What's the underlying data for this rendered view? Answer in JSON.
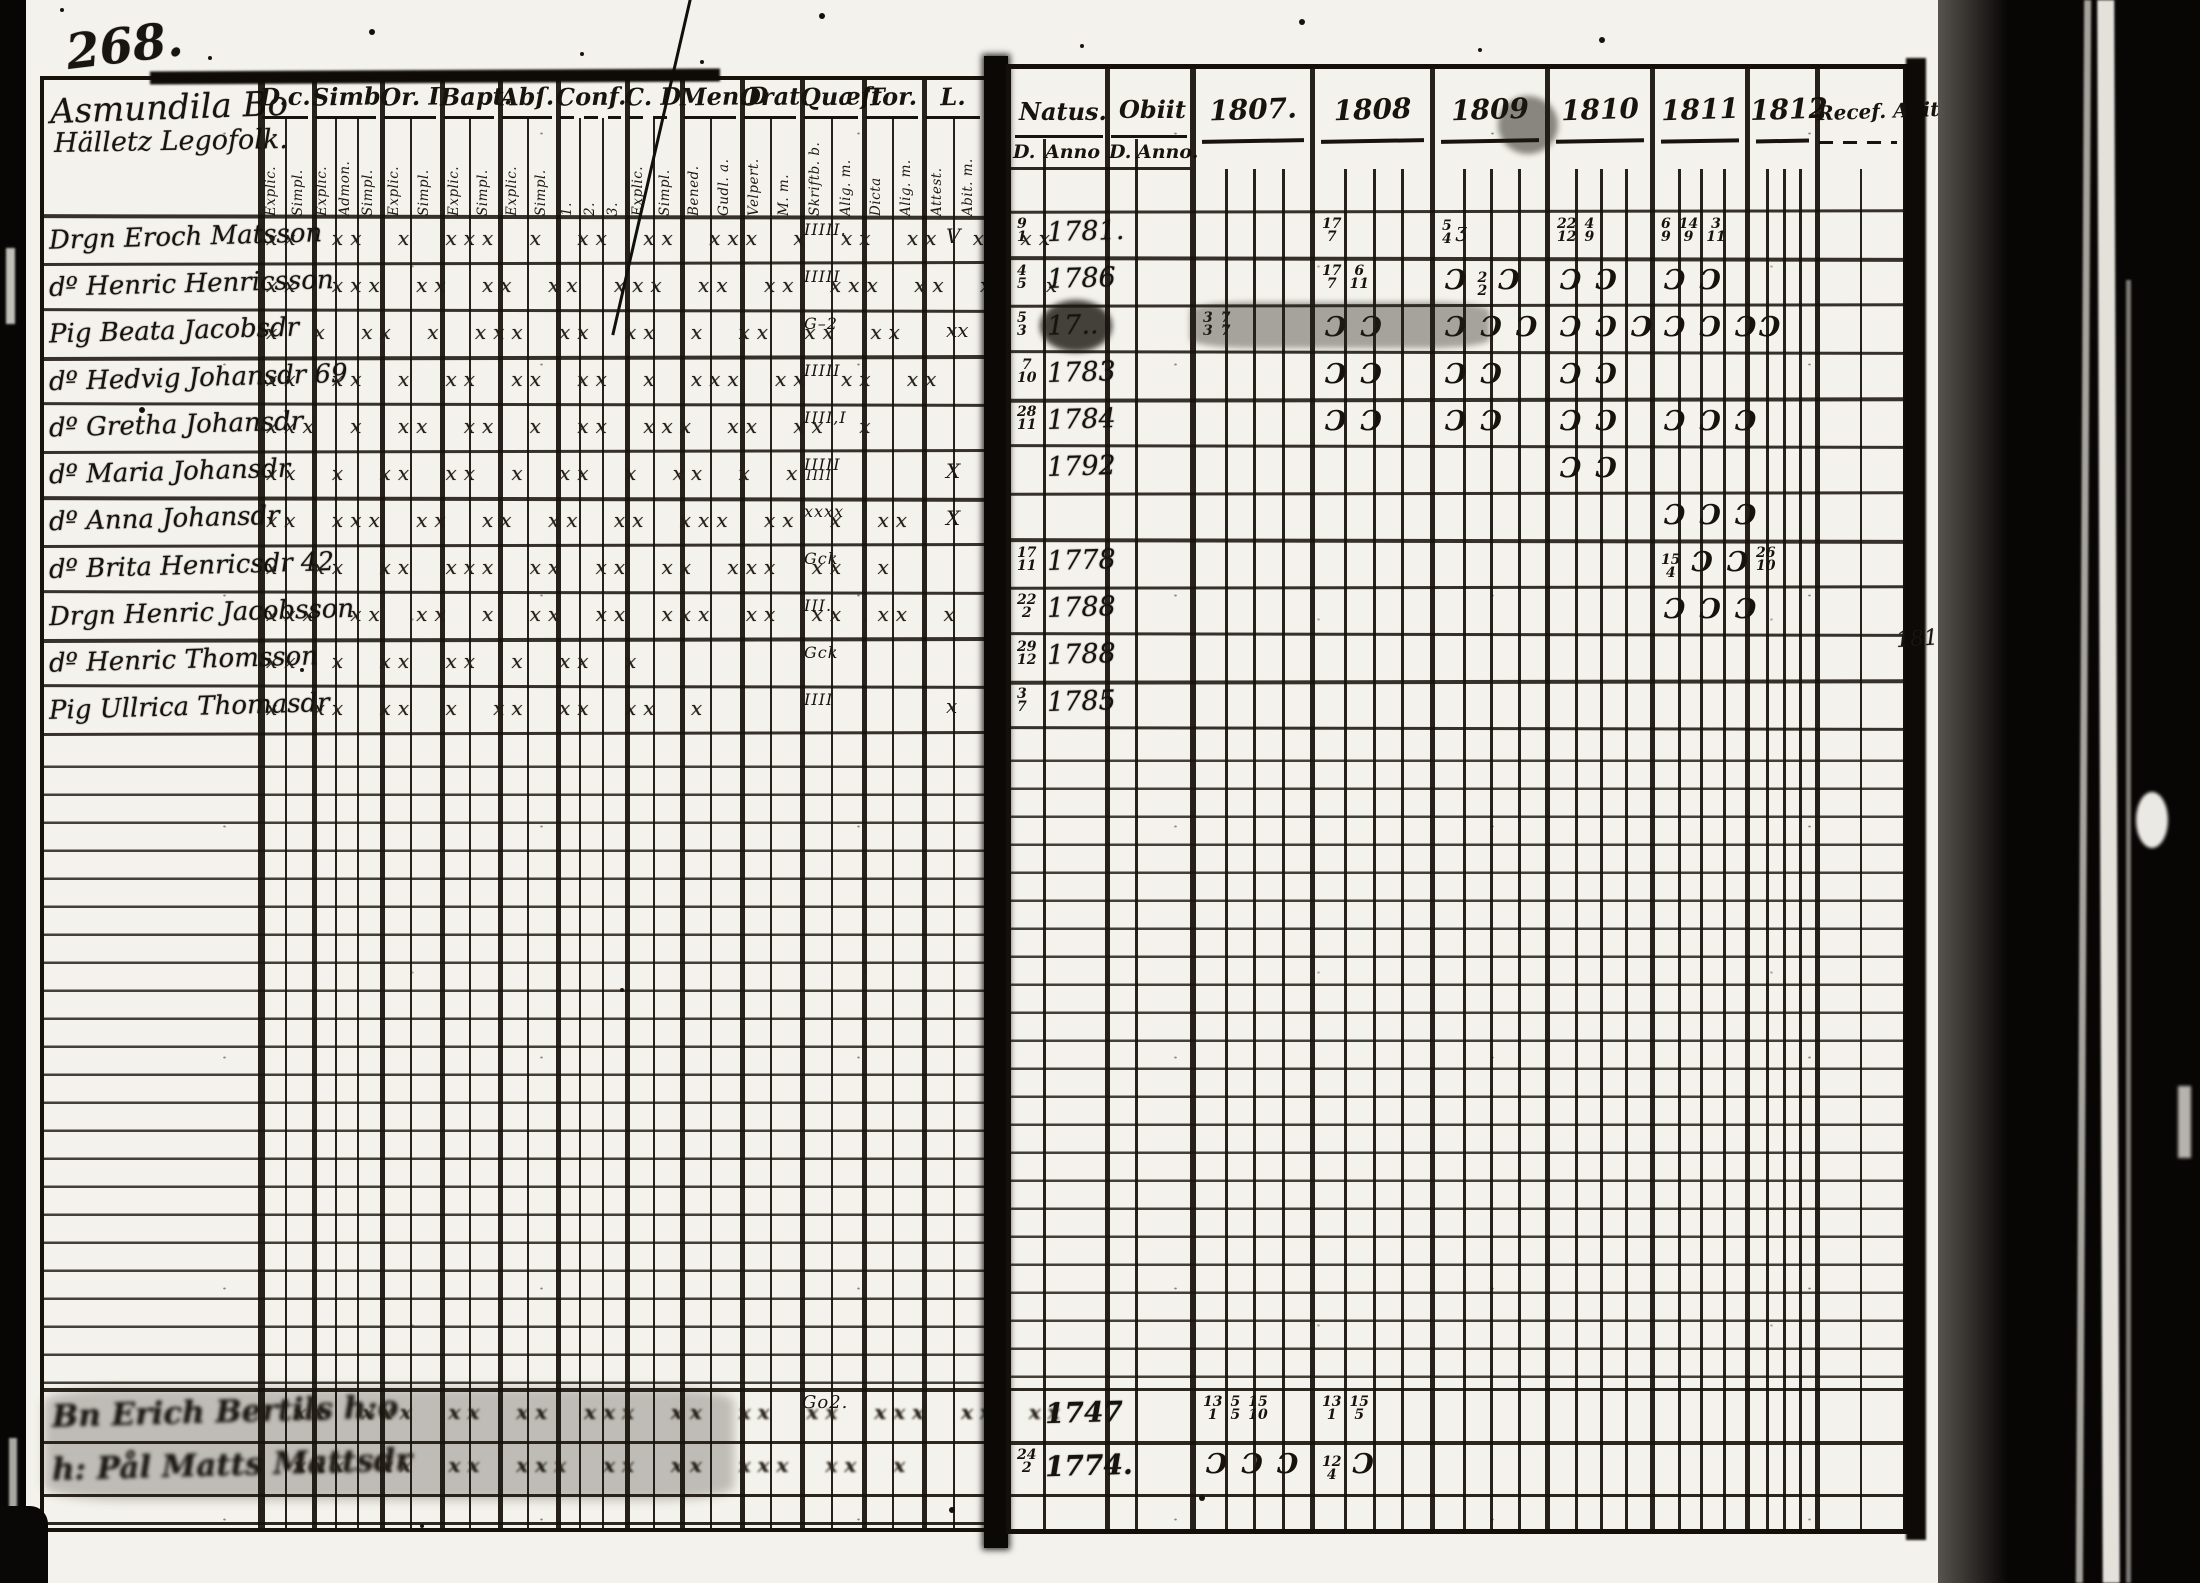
{
  "film": {
    "page_number": "268."
  },
  "left_page": {
    "title_line1": "Asmundila Bo",
    "title_line2": "Hälletz Legofolk.",
    "columns": [
      {
        "label": "D.c.",
        "subs": [
          "Explic.",
          "Simpl."
        ]
      },
      {
        "label": "Simb.",
        "subs": [
          "Explic.",
          "Admon.",
          "Simpl."
        ]
      },
      {
        "label": "Or. I",
        "subs": [
          "Explic.",
          "Simpl."
        ]
      },
      {
        "label": "Bapt.",
        "subs": [
          "Explic.",
          "Simpl."
        ]
      },
      {
        "label": "Abſ.",
        "subs": [
          "Explic.",
          "Simpl."
        ]
      },
      {
        "label": "Conf.",
        "subs": [
          "1.",
          "2.",
          "3."
        ]
      },
      {
        "label": "C. D",
        "subs": [
          "Explic.",
          "Simpl."
        ]
      },
      {
        "label": "Men.D",
        "subs": [
          "Bened.",
          "Gudl. a."
        ]
      },
      {
        "label": "Orat.",
        "subs": [
          "Velpert.",
          "M. m."
        ]
      },
      {
        "label": "Quæſt",
        "subs": [
          "Skriftb. b.",
          "Alig. m."
        ]
      },
      {
        "label": "Tor.",
        "subs": [
          "Dicta",
          "Alig. m."
        ]
      },
      {
        "label": "L.",
        "subs": [
          "Attest.",
          "Abit. m."
        ]
      }
    ],
    "rows": [
      {
        "name": "Drgn Eroch Matsson",
        "marks": "xx xx x xxx x xx xx xxx x xx xx x xx",
        "quaest": "IIIII.",
        "tail": "V"
      },
      {
        "name": "dº Henric Henricsson",
        "marks": "xx xxx xx xx xx xxx xx xx xxx xx xx x",
        "quaest": "IIIII",
        "tail": ""
      },
      {
        "name": "Pig Beata Jacobsdr",
        "marks": "x x xx x xxx xx xx x xx xx xx",
        "quaest": "G–2",
        "tail": "xx"
      },
      {
        "name": "dº Hedvig Johansdr 69",
        "marks": "xx xx x xx xx xx x xxx xx xx xx",
        "quaest": "IIIII",
        "tail": ""
      },
      {
        "name": "dº Gretha Johansdr",
        "marks": "xxx x xx xx x xx xxx xx xx x",
        "quaest": "IIII,I",
        "tail": ""
      },
      {
        "name": "dº Maria Johansdr",
        "marks": "xx x xx xx x xx x xx x x",
        "quaest": "IIIII",
        "tail": "X"
      },
      {
        "name": "dº Anna Johansdr",
        "marks": "xx xxx xx xx xx xx xxx xx x xx",
        "quaest": "xxxx",
        "tail": "X"
      },
      {
        "name": "dº Brita Henricsdr 42",
        "marks": "x xx xx xxx xx xx xx xxx xx x",
        "quaest": "Gck",
        "tail": ""
      },
      {
        "name": "Drgn Henric Jacobsson",
        "marks": "xxx xx xx x xx xx xxx xx xx xx x",
        "quaest": "III.",
        "tail": ""
      },
      {
        "name": "dº Henric Thomsson",
        "marks": "xx x xx xx x xx x",
        "quaest": "Gck",
        "tail": ""
      },
      {
        "name": "Pig Ullrica Thomasdr",
        "marks": "x xx xx x xx xx xx x",
        "quaest": "IIII",
        "tail": "x"
      }
    ],
    "extra_tally": "IIII",
    "bottom_rows": [
      {
        "name": "Bn Erich Bertils h:o",
        "marks": "xx xxx xx xx xxx xx xx xx xxx xx xx",
        "quaest": "Go2."
      },
      {
        "name": "h: Pål Matts Mattsdr",
        "marks": "xxx xx xx xxx xx xx xxx xx x",
        "quaest": ""
      }
    ]
  },
  "right_page": {
    "natus": {
      "label": "Natus.",
      "sub_d": "D.",
      "sub_anno": "Anno"
    },
    "obiit": {
      "label": "Obiit",
      "sub_d": "D.",
      "sub_anno": "Anno."
    },
    "years": [
      "1807.",
      "1808",
      "1809",
      "1810",
      "1811",
      "1812"
    ],
    "recess_label": "Recef. Abit.",
    "annotation": "1811.",
    "rows": [
      {
        "natus_d": "9/1",
        "natus_anno": "1781.",
        "obiit_d": "",
        "obiit_anno": "",
        "marks": {
          "1808": "17/7",
          "1809": "5/4 ʒ",
          "1810": "22/12 4/9",
          "1811": "6/9 14/9 3/11"
        }
      },
      {
        "natus_d": "4/5",
        "natus_anno": "1786",
        "obiit_d": "",
        "obiit_anno": "",
        "marks": {
          "1808": "17/7 6/11",
          "1809": "Ɔ 2/2 Ɔ",
          "1810": "Ɔ Ɔ",
          "1811": "Ɔ Ɔ"
        }
      },
      {
        "natus_d": "5/3",
        "natus_anno": "17..",
        "obiit_d": "",
        "obiit_anno": "",
        "marks": {
          "1807": "3/3 7/7",
          "1808": "Ɔ Ɔ",
          "1809": "Ɔ Ɔ Ɔ",
          "1810": "Ɔ Ɔ Ɔ",
          "1811": "Ɔ Ɔ Ɔ",
          "1812": "Ɔ"
        }
      },
      {
        "natus_d": "7/10",
        "natus_anno": "1783",
        "obiit_d": "",
        "obiit_anno": "",
        "marks": {
          "1808": "Ɔ Ɔ",
          "1809": "Ɔ Ɔ",
          "1810": "Ɔ Ɔ"
        }
      },
      {
        "natus_d": "28/11",
        "natus_anno": "1784",
        "obiit_d": "",
        "obiit_anno": "",
        "marks": {
          "1808": "Ɔ Ɔ",
          "1809": "Ɔ Ɔ",
          "1810": "Ɔ Ɔ",
          "1811": "Ɔ Ɔ Ɔ"
        }
      },
      {
        "natus_d": "",
        "natus_anno": "1792",
        "obiit_d": "",
        "obiit_anno": "",
        "marks": {
          "1810": "Ɔ Ɔ"
        }
      },
      {
        "natus_d": "",
        "natus_anno": "",
        "obiit_d": "",
        "obiit_anno": "",
        "marks": {
          "1811": "Ɔ Ɔ Ɔ"
        }
      },
      {
        "natus_d": "17/11",
        "natus_anno": "1778",
        "obiit_d": "",
        "obiit_anno": "",
        "marks": {
          "1811": "15/4 Ɔ Ɔ",
          "1812": "26/10"
        }
      },
      {
        "natus_d": "22/2",
        "natus_anno": "1788",
        "obiit_d": "",
        "obiit_anno": "",
        "marks": {
          "1811": "Ɔ Ɔ Ɔ"
        }
      },
      {
        "natus_d": "29/12",
        "natus_anno": "1788",
        "obiit_d": "",
        "obiit_anno": "",
        "marks": {}
      },
      {
        "natus_d": "3/7",
        "natus_anno": "1785",
        "obiit_d": "",
        "obiit_anno": "",
        "marks": {}
      }
    ],
    "bottom_rows": [
      {
        "natus_d": "",
        "natus_anno": "1747",
        "marks": {
          "1807": "13/1 5/5 15/10",
          "1808": "13/1 15/5"
        }
      },
      {
        "natus_d": "24/2",
        "natus_anno": "1774.",
        "marks": {
          "1807": "Ɔ Ɔ Ɔ",
          "1808": "12/4 Ɔ"
        }
      }
    ]
  }
}
